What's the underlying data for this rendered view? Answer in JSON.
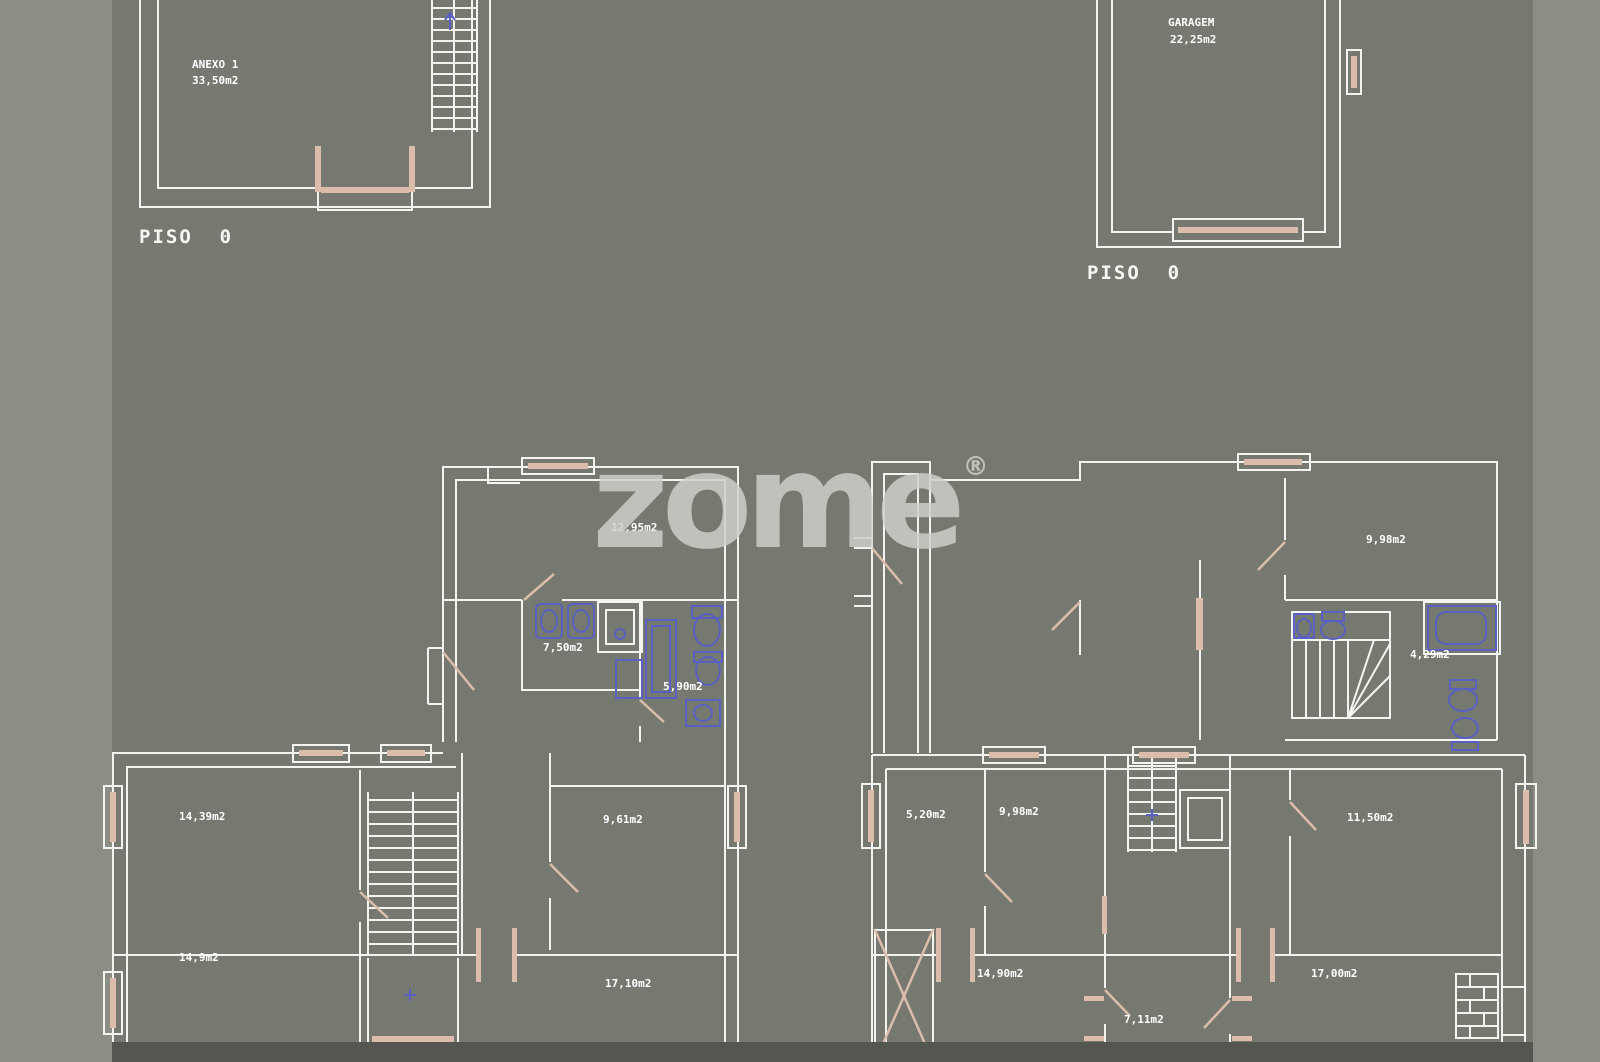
{
  "watermark": {
    "brand": "zome",
    "registered": "®"
  },
  "plans": {
    "anexo": {
      "floor": "PISO  0",
      "name": "ANEXO 1",
      "area": "33,50m2"
    },
    "garagem": {
      "floor": "PISO  0",
      "name": "GARAGEM",
      "area": "22,25m2"
    },
    "house_left": {
      "rooms": {
        "sala": "12,95m2",
        "bath_a": "7,50m2",
        "bath_b": "5,90m2",
        "bed_a": "14,39m2",
        "bed_b": "9,61m2",
        "bed_c": "14,9m2",
        "living": "17,10m2"
      }
    },
    "house_right": {
      "rooms": {
        "top_bed": "9,98m2",
        "stair_hall": "4,29m2",
        "room_a": "5,20m2",
        "room_b": "9,98m2",
        "room_c": "11,50m2",
        "room_d": "14,90m2",
        "hall": "7,11m2",
        "living": "17,00m2"
      }
    }
  },
  "colors": {
    "background": "#75796f",
    "margin_band": "#8a8e84",
    "footer_band": "#53574f",
    "wall": "#f3f4ef",
    "joinery": "#dcbcab",
    "fixtures": "#5a60c2",
    "watermark": "#ccd1c9",
    "label_text": "#ffffff"
  }
}
